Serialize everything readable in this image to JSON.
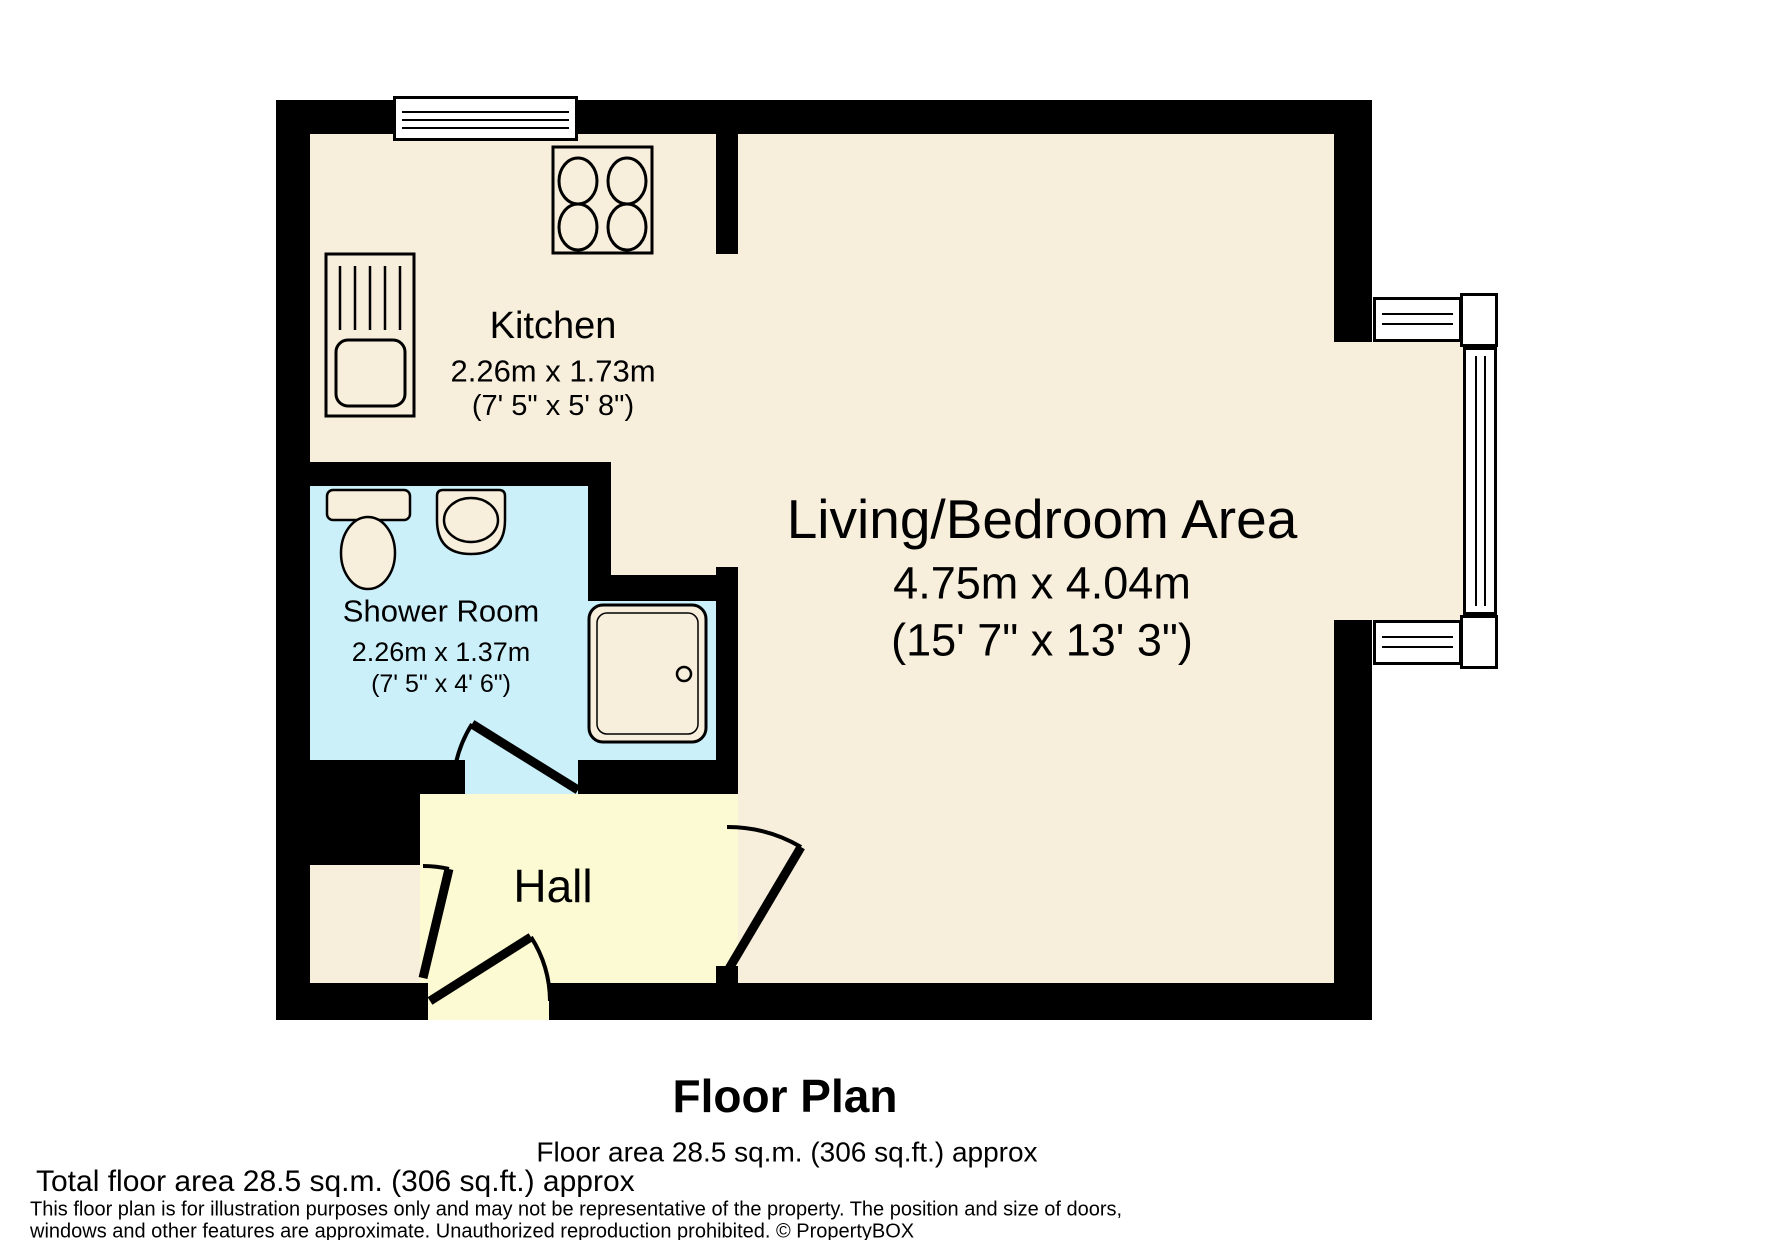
{
  "floor_plan": {
    "rooms": [
      {
        "name": "Kitchen",
        "dims_metric": "2.26m x 1.73m",
        "dims_imperial": "(7' 5\" x 5' 8\")"
      },
      {
        "name": "Shower Room",
        "dims_metric": "2.26m x 1.37m",
        "dims_imperial": "(7' 5\" x 4' 6\")"
      },
      {
        "name": "Living/Bedroom Area",
        "dims_metric": "4.75m x 4.04m",
        "dims_imperial": "(15' 7\" x 13' 3\")"
      },
      {
        "name": "Hall"
      }
    ],
    "colors": {
      "wall": "#000000",
      "floor": "#f7eedc",
      "shower_room_floor": "#cbf0fa",
      "hall_floor": "#fcfad3",
      "outside": "#ffffff"
    },
    "footer": {
      "title": "Floor Plan",
      "floor_area": "Floor area 28.5 sq.m. (306 sq.ft.) approx",
      "total_floor_area": "Total floor area 28.5 sq.m. (306 sq.ft.) approx",
      "disclaimer_line1": "This floor plan is for illustration purposes only and may not be representative of the property. The position and size of doors,",
      "disclaimer_line2": "windows and other features are approximate. Unauthorized reproduction prohibited. © PropertyBOX"
    }
  }
}
